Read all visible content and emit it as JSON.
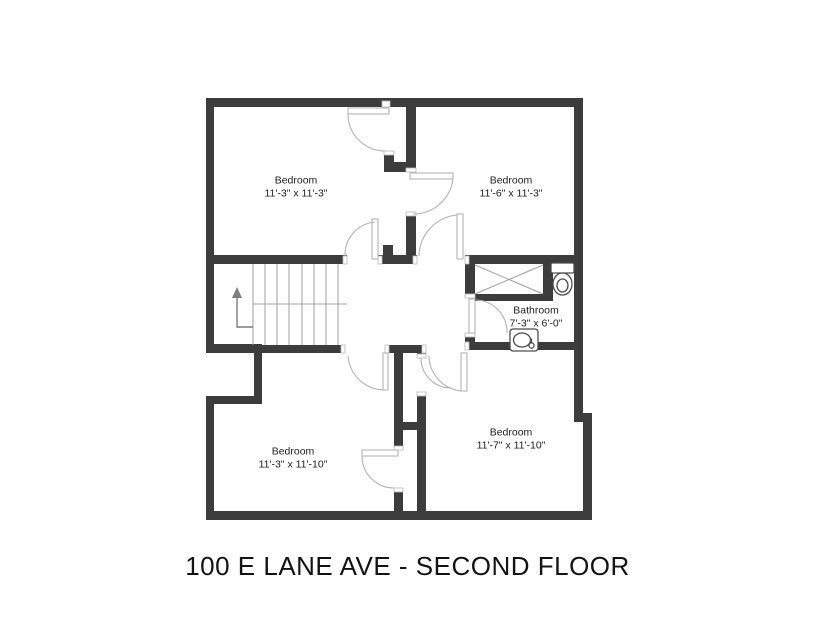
{
  "title": "100 E LANE AVE - SECOND FLOOR",
  "colors": {
    "wall": "#3c3c3c",
    "door_arc": "#b4b4b4",
    "thin_line": "#a2a2a2",
    "text": "#1f1f1f"
  },
  "rooms": [
    {
      "id": "bedroom-top-left",
      "name": "Bedroom",
      "dims": "11'-3\" x 11'-3\"",
      "cx": 296,
      "cy": 187
    },
    {
      "id": "bedroom-top-right",
      "name": "Bedroom",
      "dims": "11'-6\" x 11'-3\"",
      "cx": 511,
      "cy": 187
    },
    {
      "id": "bathroom",
      "name": "Bathroom",
      "dims": "7'-3\" x 6'-0\"",
      "cx": 536,
      "cy": 317
    },
    {
      "id": "bedroom-bottom-left",
      "name": "Bedroom",
      "dims": "11'-3\" x 11'-10\"",
      "cx": 293,
      "cy": 458
    },
    {
      "id": "bedroom-bottom-right",
      "name": "Bedroom",
      "dims": "11'-7\" x 11'-10\"",
      "cx": 511,
      "cy": 439
    }
  ],
  "geometry": {
    "shapes": [
      {
        "kind": "rect",
        "cls": "wall",
        "name": "wall-exterior-top",
        "x": 206,
        "y": 98,
        "w": 377,
        "h": 9
      },
      {
        "kind": "rect",
        "cls": "wall",
        "name": "wall-exterior-left-upper",
        "x": 206,
        "y": 98,
        "w": 8,
        "h": 254
      },
      {
        "kind": "rect",
        "cls": "wall",
        "name": "wall-notch-top",
        "x": 206,
        "y": 344,
        "w": 56,
        "h": 9
      },
      {
        "kind": "rect",
        "cls": "wall",
        "name": "wall-notch-right",
        "x": 254,
        "y": 344,
        "w": 8,
        "h": 60
      },
      {
        "kind": "rect",
        "cls": "wall",
        "name": "wall-notch-bottom",
        "x": 206,
        "y": 396,
        "w": 56,
        "h": 8
      },
      {
        "kind": "rect",
        "cls": "wall",
        "name": "wall-exterior-left-lower",
        "x": 206,
        "y": 396,
        "w": 8,
        "h": 124
      },
      {
        "kind": "rect",
        "cls": "wall",
        "name": "wall-exterior-bottom",
        "x": 206,
        "y": 511,
        "w": 386,
        "h": 9
      },
      {
        "kind": "rect",
        "cls": "wall",
        "name": "wall-exterior-right-upper",
        "x": 574,
        "y": 98,
        "w": 9,
        "h": 324
      },
      {
        "kind": "rect",
        "cls": "wall",
        "name": "wall-exterior-right-step",
        "x": 574,
        "y": 413,
        "w": 18,
        "h": 9
      },
      {
        "kind": "rect",
        "cls": "wall",
        "name": "wall-exterior-right-lower",
        "x": 583,
        "y": 413,
        "w": 9,
        "h": 107
      },
      {
        "kind": "rect",
        "cls": "wall",
        "name": "wall-top-bedrooms-divider",
        "x": 406,
        "y": 107,
        "w": 10,
        "h": 55
      },
      {
        "kind": "rect",
        "cls": "wall",
        "name": "wall-tl-door-stub",
        "x": 384,
        "y": 151,
        "w": 10,
        "h": 21
      },
      {
        "kind": "rect",
        "cls": "wall",
        "name": "wall-divider-jog",
        "x": 384,
        "y": 162,
        "w": 32,
        "h": 10
      },
      {
        "kind": "rect",
        "cls": "wall",
        "name": "wall-tr-west-lower",
        "x": 406,
        "y": 212,
        "w": 10,
        "h": 45
      },
      {
        "kind": "rect",
        "cls": "wall",
        "name": "wall-stair-north",
        "x": 206,
        "y": 255,
        "w": 141,
        "h": 9
      },
      {
        "kind": "rect",
        "cls": "wall",
        "name": "wall-hall-cap",
        "x": 378,
        "y": 255,
        "w": 39,
        "h": 9
      },
      {
        "kind": "rect",
        "cls": "wall",
        "name": "wall-stub-above-cap",
        "x": 383,
        "y": 245,
        "w": 10,
        "h": 10
      },
      {
        "kind": "rect",
        "cls": "wall",
        "name": "wall-bathroom-north",
        "x": 465,
        "y": 255,
        "w": 109,
        "h": 9
      },
      {
        "kind": "rect",
        "cls": "wall",
        "name": "wall-closet-west",
        "x": 465,
        "y": 255,
        "w": 10,
        "h": 43
      },
      {
        "kind": "rect",
        "cls": "wall",
        "name": "wall-closet-east",
        "x": 543,
        "y": 255,
        "w": 10,
        "h": 46
      },
      {
        "kind": "rect",
        "cls": "wall",
        "name": "wall-closet-south",
        "x": 475,
        "y": 294,
        "w": 68,
        "h": 7
      },
      {
        "kind": "rect",
        "cls": "wall",
        "name": "wall-bath-door-stub",
        "x": 465,
        "y": 333,
        "w": 10,
        "h": 17
      },
      {
        "kind": "rect",
        "cls": "wall",
        "name": "wall-bathroom-south",
        "x": 465,
        "y": 342,
        "w": 109,
        "h": 8
      },
      {
        "kind": "rect",
        "cls": "wall",
        "name": "wall-stair-south",
        "x": 206,
        "y": 345,
        "w": 139,
        "h": 8
      },
      {
        "kind": "rect",
        "cls": "wall",
        "name": "wall-hall-south-center",
        "x": 385,
        "y": 345,
        "w": 41,
        "h": 8
      },
      {
        "kind": "rect",
        "cls": "wall",
        "name": "wall-chase-corner",
        "x": 417,
        "y": 345,
        "w": 9,
        "h": 13
      },
      {
        "kind": "rect",
        "cls": "wall",
        "name": "wall-bottom-divider-upper",
        "x": 394,
        "y": 353,
        "w": 9,
        "h": 97
      },
      {
        "kind": "rect",
        "cls": "wall",
        "name": "wall-bottom-divider-right",
        "x": 417,
        "y": 392,
        "w": 9,
        "h": 119
      },
      {
        "kind": "rect",
        "cls": "wall",
        "name": "wall-chase-bridge",
        "x": 394,
        "y": 422,
        "w": 32,
        "h": 8
      },
      {
        "kind": "rect",
        "cls": "wall",
        "name": "wall-bottom-divider-lower",
        "x": 394,
        "y": 488,
        "w": 9,
        "h": 23
      },
      {
        "kind": "rect",
        "cls": "jamb",
        "name": "door-jamb",
        "x": 382,
        "y": 101,
        "w": 8,
        "h": 6
      },
      {
        "kind": "rect",
        "cls": "jamb",
        "name": "door-jamb",
        "x": 384,
        "y": 151,
        "w": 10,
        "h": 4
      },
      {
        "kind": "rect",
        "cls": "jamb",
        "name": "door-jamb",
        "x": 406,
        "y": 168,
        "w": 10,
        "h": 4
      },
      {
        "kind": "rect",
        "cls": "jamb",
        "name": "door-jamb",
        "x": 406,
        "y": 212,
        "w": 10,
        "h": 4
      },
      {
        "kind": "rect",
        "cls": "jamb",
        "name": "door-jamb",
        "x": 413,
        "y": 256,
        "w": 4,
        "h": 8
      },
      {
        "kind": "rect",
        "cls": "jamb",
        "name": "door-jamb",
        "x": 465,
        "y": 256,
        "w": 4,
        "h": 8
      },
      {
        "kind": "rect",
        "cls": "jamb",
        "name": "door-jamb",
        "x": 343,
        "y": 256,
        "w": 4,
        "h": 8
      },
      {
        "kind": "rect",
        "cls": "jamb",
        "name": "door-jamb",
        "x": 378,
        "y": 256,
        "w": 4,
        "h": 8
      },
      {
        "kind": "rect",
        "cls": "jamb",
        "name": "door-jamb",
        "x": 465,
        "y": 294,
        "w": 10,
        "h": 4
      },
      {
        "kind": "rect",
        "cls": "jamb",
        "name": "door-jamb",
        "x": 465,
        "y": 333,
        "w": 10,
        "h": 4
      },
      {
        "kind": "rect",
        "cls": "jamb",
        "name": "door-jamb",
        "x": 341,
        "y": 345,
        "w": 4,
        "h": 8
      },
      {
        "kind": "rect",
        "cls": "jamb",
        "name": "door-jamb",
        "x": 385,
        "y": 345,
        "w": 4,
        "h": 8
      },
      {
        "kind": "rect",
        "cls": "jamb",
        "name": "door-jamb",
        "x": 422,
        "y": 345,
        "w": 4,
        "h": 8
      },
      {
        "kind": "rect",
        "cls": "jamb",
        "name": "door-jamb",
        "x": 465,
        "y": 342,
        "w": 4,
        "h": 8
      },
      {
        "kind": "rect",
        "cls": "jamb",
        "name": "door-jamb",
        "x": 417,
        "y": 354,
        "w": 9,
        "h": 4
      },
      {
        "kind": "rect",
        "cls": "jamb",
        "name": "door-jamb",
        "x": 417,
        "y": 392,
        "w": 9,
        "h": 4
      },
      {
        "kind": "rect",
        "cls": "jamb",
        "name": "door-jamb",
        "x": 394,
        "y": 446,
        "w": 9,
        "h": 4
      },
      {
        "kind": "rect",
        "cls": "jamb",
        "name": "door-jamb",
        "x": 394,
        "y": 488,
        "w": 9,
        "h": 4
      },
      {
        "kind": "rect",
        "cls": "leaf",
        "name": "door-leaf-bedroom-top-left",
        "x": 348,
        "y": 108,
        "w": 41,
        "h": 6
      },
      {
        "kind": "rect",
        "cls": "leaf",
        "name": "door-leaf-bedroom-top-right",
        "x": 410,
        "y": 173,
        "w": 43,
        "h": 6
      },
      {
        "kind": "rect",
        "cls": "leaf",
        "name": "door-leaf-bedroom-top-right-south",
        "x": 457,
        "y": 214,
        "w": 6,
        "h": 45
      },
      {
        "kind": "rect",
        "cls": "leaf",
        "name": "door-leaf-stairs",
        "x": 372,
        "y": 219,
        "w": 6,
        "h": 40
      },
      {
        "kind": "rect",
        "cls": "leaf",
        "name": "door-leaf-bathroom",
        "x": 469,
        "y": 299,
        "w": 6,
        "h": 34
      },
      {
        "kind": "rect",
        "cls": "leaf",
        "name": "door-leaf-bedroom-bottom-left",
        "x": 383,
        "y": 353,
        "w": 5,
        "h": 37
      },
      {
        "kind": "rect",
        "cls": "leaf",
        "name": "door-leaf-bedroom-bottom-right",
        "x": 461,
        "y": 353,
        "w": 6,
        "h": 38
      },
      {
        "kind": "rect",
        "cls": "leaf",
        "name": "door-leaf-closet-bottom-left",
        "x": 362,
        "y": 450,
        "w": 36,
        "h": 6
      },
      {
        "kind": "path",
        "cls": "arc",
        "name": "door-arc-bedroom-top-left",
        "d": "M 348 114 A 37 37 0 0 0 385 151"
      },
      {
        "kind": "path",
        "cls": "arc",
        "name": "door-arc-bedroom-top-right",
        "d": "M 453 179 A 40 40 0 0 1 413 214"
      },
      {
        "kind": "path",
        "cls": "arc",
        "name": "door-arc-bedroom-top-right-south",
        "d": "M 419 256 A 42 42 0 0 1 457 215"
      },
      {
        "kind": "path",
        "cls": "arc",
        "name": "door-arc-stairs",
        "d": "M 345 256 A 33 33 0 0 1 375 222"
      },
      {
        "kind": "path",
        "cls": "arc",
        "name": "door-arc-bathroom",
        "d": "M 476 300 A 32 32 0 0 1 507 333"
      },
      {
        "kind": "path",
        "cls": "arc",
        "name": "door-arc-bedroom-bottom-left",
        "d": "M 348 356 A 37 37 0 0 0 383 390"
      },
      {
        "kind": "path",
        "cls": "arc",
        "name": "door-arc-bedroom-bottom-right",
        "d": "M 429 356 A 36 36 0 0 0 461 391"
      },
      {
        "kind": "path",
        "cls": "arc",
        "name": "door-arc-chase",
        "d": "M 421 358 A 30 30 0 0 0 451 388"
      },
      {
        "kind": "path",
        "cls": "arc",
        "name": "door-arc-closet-bottom-left",
        "d": "M 362 456 A 32 32 0 0 0 394 488"
      },
      {
        "kind": "line",
        "cls": "thin",
        "name": "stairs-edge-line",
        "x1": 253,
        "y1": 264,
        "x2": 253,
        "y2": 345
      },
      {
        "kind": "line",
        "cls": "thin",
        "name": "stairs-tread",
        "x1": 265,
        "y1": 264,
        "x2": 265,
        "y2": 345
      },
      {
        "kind": "line",
        "cls": "thin",
        "name": "stairs-tread",
        "x1": 277,
        "y1": 264,
        "x2": 277,
        "y2": 345
      },
      {
        "kind": "line",
        "cls": "thin",
        "name": "stairs-tread",
        "x1": 289,
        "y1": 264,
        "x2": 289,
        "y2": 345
      },
      {
        "kind": "line",
        "cls": "thin",
        "name": "stairs-tread",
        "x1": 302,
        "y1": 264,
        "x2": 302,
        "y2": 345
      },
      {
        "kind": "line",
        "cls": "thin",
        "name": "stairs-tread",
        "x1": 314,
        "y1": 264,
        "x2": 314,
        "y2": 345
      },
      {
        "kind": "line",
        "cls": "thin",
        "name": "stairs-tread",
        "x1": 326,
        "y1": 264,
        "x2": 326,
        "y2": 345
      },
      {
        "kind": "line",
        "cls": "thin",
        "name": "stairs-tread",
        "x1": 338,
        "y1": 264,
        "x2": 338,
        "y2": 345
      },
      {
        "kind": "line",
        "cls": "thin",
        "name": "stairs-landing-line",
        "x1": 253,
        "y1": 304,
        "x2": 347,
        "y2": 304
      },
      {
        "kind": "line",
        "cls": "thin",
        "name": "closet-x-diagonal",
        "x1": 475,
        "y1": 265,
        "x2": 543,
        "y2": 294
      },
      {
        "kind": "line",
        "cls": "thin",
        "name": "closet-x-diagonal",
        "x1": 475,
        "y1": 294,
        "x2": 543,
        "y2": 265
      },
      {
        "kind": "polyline",
        "cls": "arrowline",
        "name": "stairs-up-arrow-line",
        "points": "253,327 237,327 237,295"
      },
      {
        "kind": "polygon",
        "cls": "arrowhead",
        "name": "stairs-up-arrow-head",
        "points": "237,287 232,298 242,298"
      },
      {
        "kind": "rect",
        "cls": "fixture",
        "name": "toilet-tank-icon",
        "x": 551,
        "y": 263,
        "w": 23,
        "h": 10,
        "rx": 1.5
      },
      {
        "kind": "ellipse",
        "cls": "fixture",
        "name": "toilet-bowl-icon",
        "cx": 562.5,
        "cy": 284,
        "rx": 9.5,
        "ry": 11
      },
      {
        "kind": "ellipse",
        "cls": "fixture",
        "name": "toilet-bowl-inner-icon",
        "cx": 562.5,
        "cy": 285.5,
        "rx": 5.5,
        "ry": 6.5
      },
      {
        "kind": "rect",
        "cls": "fixture",
        "name": "sink-counter-icon",
        "x": 510,
        "y": 329,
        "w": 28,
        "h": 22,
        "rx": 3
      },
      {
        "kind": "ellipse",
        "cls": "fixture",
        "name": "sink-basin-icon",
        "cx": 522,
        "cy": 340,
        "rx": 8.5,
        "ry": 7
      },
      {
        "kind": "circle",
        "cls": "fixture",
        "name": "sink-faucet-icon",
        "cx": 531.5,
        "cy": 345.5,
        "r": 2.6
      },
      {
        "kind": "line",
        "cls": "fixture",
        "name": "sink-faucet-line",
        "x1": 531.5,
        "y1": 338.5,
        "x2": 531.5,
        "y2": 343
      }
    ]
  }
}
